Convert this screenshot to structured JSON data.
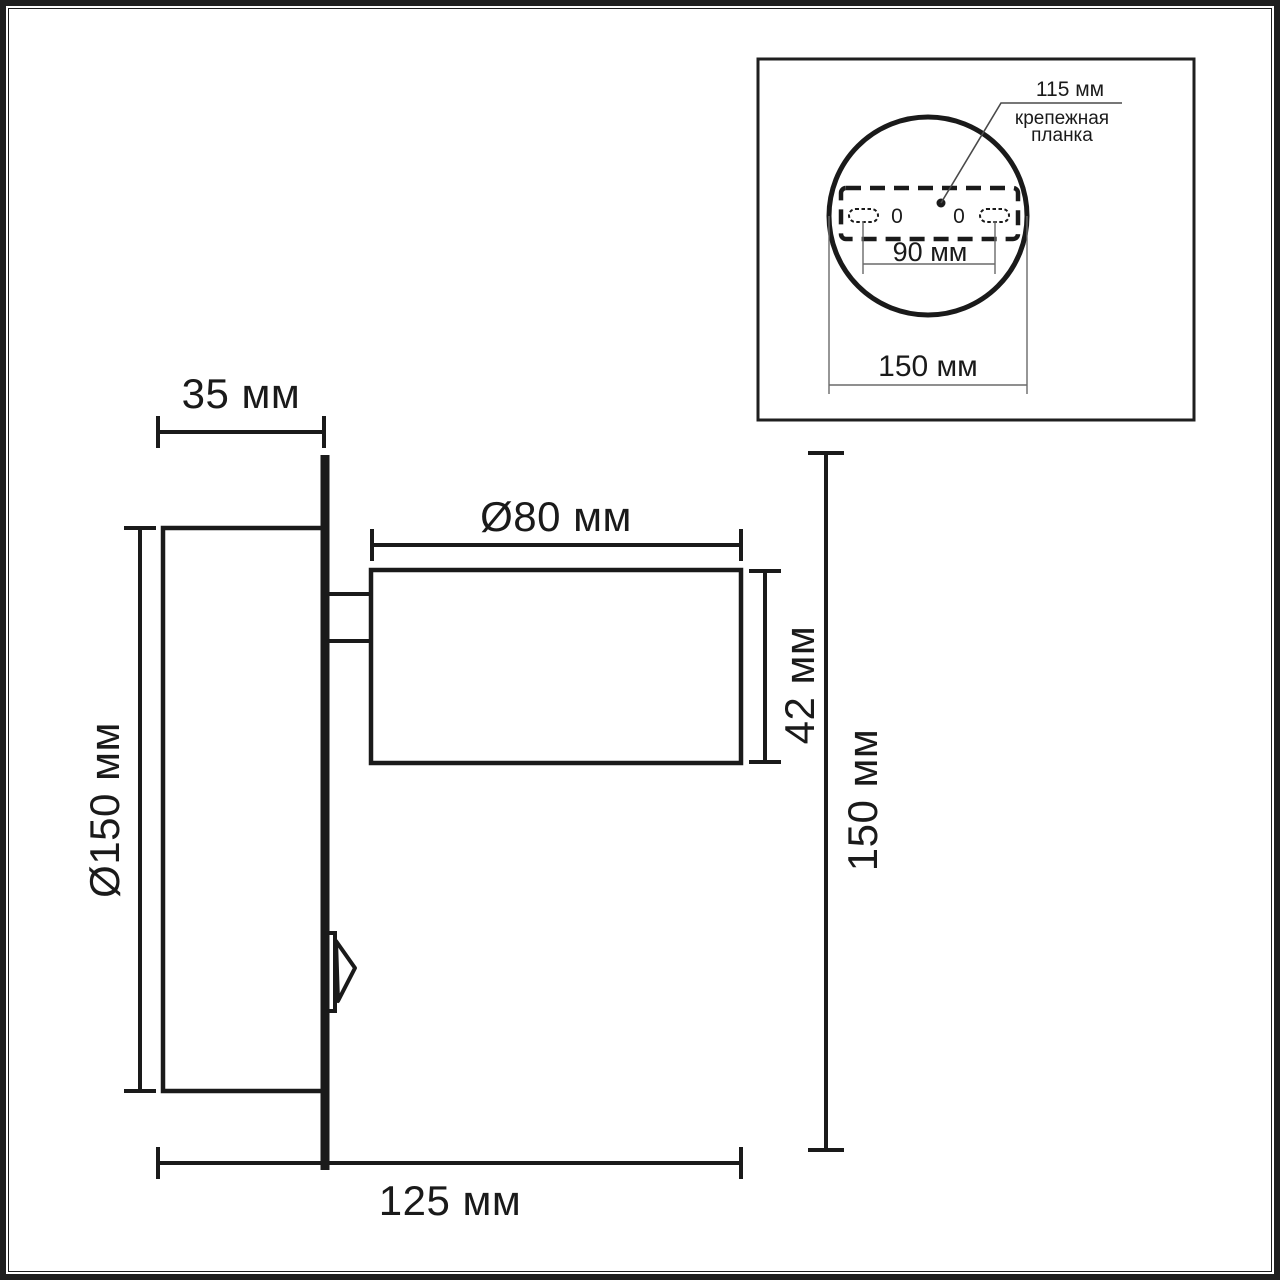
{
  "title": "Wall spot light dimensional drawing",
  "colors": {
    "background": "#ffffff",
    "frame": "#1f1f1f",
    "main_lines": "#1a1a1a",
    "thin_lines": "#6a6a6a",
    "leader_line": "#4a4a4a"
  },
  "main_view": {
    "dimensions": {
      "plate_depth": "35 мм",
      "base_diameter": "Ø150 мм",
      "spot_diameter": "Ø80 мм",
      "spot_height": "42 мм",
      "overall_height": "150 мм",
      "overall_depth": "125 мм"
    }
  },
  "inset_view": {
    "plate_width": "115 мм",
    "plate_caption_line1": "крепежная",
    "plate_caption_line2": "планка",
    "hole_spacing": "90 мм",
    "base_diameter": "150 мм",
    "hole_marks": [
      "0",
      "0"
    ]
  }
}
